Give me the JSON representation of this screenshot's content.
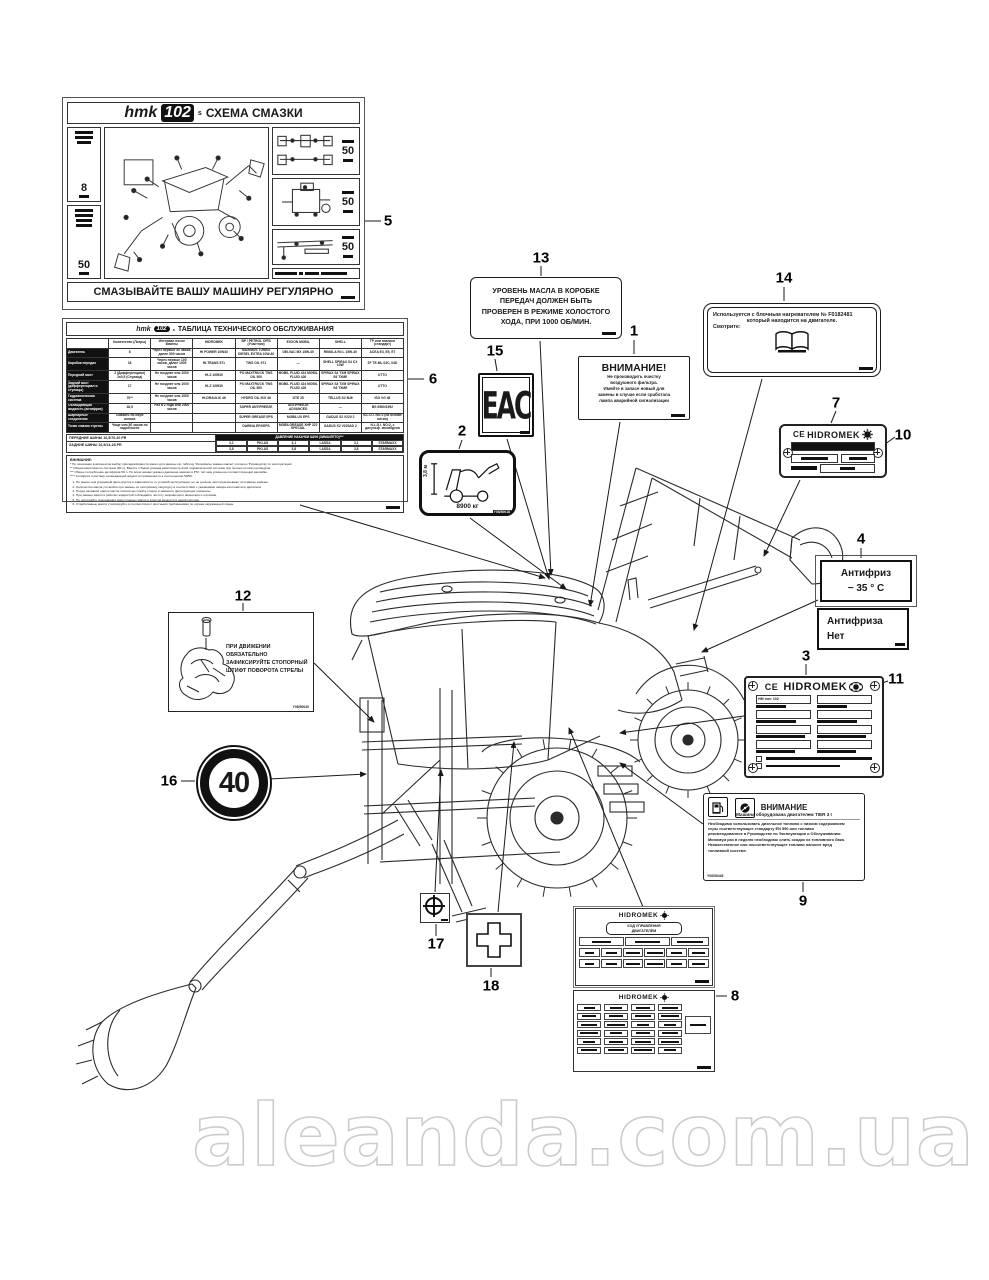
{
  "watermark": {
    "text": "aleanda.com.ua"
  },
  "callouts": {
    "c1": "1",
    "c2": "2",
    "c3": "3",
    "c4": "4",
    "c5": "5",
    "c6": "6",
    "c7": "7",
    "c8": "8",
    "c9": "9",
    "c10": "10",
    "c11": "11",
    "c12": "12",
    "c13": "13",
    "c14": "14",
    "c15": "15",
    "c16": "16",
    "c17": "17",
    "c18": "18"
  },
  "label5": {
    "brand": "hmk",
    "model": "102",
    "suffix": "s",
    "title": "СХЕМА СМАЗКИ",
    "footer": "СМАЗЫВАЙТЕ ВАШУ МАШИНУ РЕГУЛЯРНО",
    "interval_left": [
      "8",
      "50"
    ],
    "interval_right": [
      "50",
      "50",
      "50"
    ]
  },
  "label6": {
    "brand": "hmk",
    "model": "102",
    "suffix": "s",
    "title": "ТАБЛИЦА ТЕХНИЧЕСКОГО ОБСЛУЖИВАНИЯ",
    "columns": [
      "",
      "Количество (Литры)",
      "Интервал после замены",
      "HIDROMEK",
      "BP / PETROL OFİS (Участник)",
      "EXXON MOBIL",
      "SHELL",
      "ТР или аналоги (стандарт)"
    ],
    "rows": [
      [
        "Двигатель",
        "8",
        "Через первые 50 часов, далее 500 часов",
        "HI POWER 10W40",
        "MAXIMUS TURBO DIESEL EXTRA 10W-40",
        "DELVAC MX 15W-40",
        "RIMULA R4 L 15W-40",
        "ACEA E3, E5, E7"
      ],
      [
        "Коробка передач",
        "16",
        "Через первые 100 часов, далее 1000 часов",
        "HI-TRANS 971",
        "TWS OIL 971",
        "—",
        "SHELL SPIRAX S4 CX 10W",
        "ZF TE-ML 03C, 04D"
      ],
      [
        "Передний мост",
        "2 (Дифференциал) 2x0,5 (Ступица)",
        "Не позднее чем 1000 часов",
        "HI-Z 10W30",
        "PO MAXTRUCK TWS OIL 500",
        "MOBIL FLUID 424 MOBIL FLUID 426",
        "SPIRAX S4 TXM SPIRAX S6 TXME",
        "UTTO"
      ],
      [
        "Задний мост (дифференциал и ступицы)",
        "17",
        "Не позднее чем 1000 часов",
        "HI-Z 10W30",
        "PO MAXTRUCK TWS OIL 500",
        "MOBIL FLUID 424 MOBIL FLUID 426",
        "SPIRAX S4 TXM SPIRAX S6 TXME",
        "UTTO"
      ],
      [
        "Гидравлическая система",
        "70**",
        "Не позднее чем 1000 часов",
        "HI-DRAULIC 46",
        "HYDRO OIL ISO 46",
        "DTE 25",
        "TELLUS S2 B46",
        "ISO VG 46"
      ],
      [
        "Охлаждающая жидкость (антифриз)",
        "18,5",
        "Раз в 2 года или 2000 часов",
        "",
        "SUPER ANTIFREEZE",
        "ANTIFREEZE ADVANCED",
        "—",
        "BS 6580/1992"
      ],
      [
        "Шарнирные соединения",
        "Смазать по мере износа",
        "",
        "",
        "SUPER GREASE EPS",
        "MOBILUX EPS",
        "GADUS S2 V220 2",
        "N.L.G.I. NO:2 (на основе лития)"
      ],
      [
        "Точки смазки стрелы",
        "Чаще чем 50 часов по надобности",
        "",
        "",
        "DARINA EP2/EPS",
        "MOBILGREASE XHP 222 SPECIAL",
        "GADUS S2 V220AD 2",
        "N.L.G.I. NO:2, с дисульф. молибдена"
      ]
    ],
    "tires_front": "ПЕРЕДНИЕ ШИНЫ   16,5/70-20 PR",
    "tires_rear": "ЗАДНИЕ ШИНЫ   16,9/14-28 PR",
    "pressure_title": "ДАВЛЕНИЕ НАКАЧКИ ШИН (ЗИМА/ЛЕТО)***",
    "pressure_rows": [
      [
        "3,1",
        "PKLAS",
        "4,1",
        "LASSA",
        "3,1",
        "STARMAXX"
      ],
      [
        "3,8",
        "PKLAS",
        "3,8",
        "LASSA",
        "3,8",
        "STARMAXX"
      ]
    ],
    "notes_title": "ВНИМАНИЕ:",
    "notes": [
      "* По окончании компонентов выбор присадок/вязкости масел для замены см. таблицу 'Интервалы замены масел' согласно 'Руководству по эксплуатации'.",
      "** Общая вместимость системы (80 л). Вместе с баком указана вместимость всей гидравлической системы при полных штоках цилиндров.",
      "*** Общее потребление антифриза 50 л. По всем шинам указано давление накачки в PSI; тип шин указан на соответствующей наклейке.",
      "**** Антифриз и раствор охлаждающей жидкости применяются в соотношении 50/50."
    ],
    "list": [
      "Не менее чем указанный фильтруется в зависимости от условий эксплуатации, но не дольше чем предписывают интервалы замены.",
      "Количество масла уточняйте при замене по смотровому окну/щупу в соответствии с указаниями завода-изготовителя двигателя.",
      "Перед заливкой нового масла полностью слейте старое и замените фильтрующие элементы.",
      "При замене масел и рабочих жидкостей соблюдайте чистоту заправочного инвентаря и горловин.",
      "Не допускайте смешивания масел разных марок и классов вязкости в одной системе.",
      "Отработанные масла утилизируйте в соответствии с местными требованиями по охране окружающей среды."
    ]
  },
  "label13": {
    "lines": [
      "УРОВЕНЬ МАСЛА В КОРОБКЕ",
      "ПЕРЕДАЧ ДОЛЖЕН БЫТЬ",
      "ПРОВЕРЕН В РЕЖИМЕ ХОЛОСТОГО",
      "ХОДА, ПРИ 1000 ОБ/МИН."
    ]
  },
  "label14": {
    "line1": "Используется с блочным нагревателем  №  F0182481",
    "line2": "который находится на двигателе.",
    "line3": "Смотрите:"
  },
  "label1": {
    "title": "ВНИМАНИЕ!",
    "lines": [
      "Не производить очистку",
      "воздушного фильтра.",
      "Имейте в запасе новый для",
      "замены в случае если сработала",
      "лампа аварийной сигнализации"
    ]
  },
  "label15": {
    "text": "EAC"
  },
  "label2": {
    "height": "3,8 м",
    "weight": "8900 кг",
    "code": "Y08/50018"
  },
  "label7": {
    "ce": "CE",
    "brand": "HIDROMEK"
  },
  "label10_note": "",
  "label4": {
    "top1": "Антифриз",
    "top2": "− 35 ° C",
    "bottom1": "Антифриза",
    "bottom2": "Нет"
  },
  "label3": {
    "ce": "CE",
    "brand": "HIDROMEK",
    "field1": "HM тип: 102"
  },
  "label9": {
    "title": "ВНИМАНИЕ",
    "subtitle": "Машина оборудована двигателем TIER 3 I",
    "lines": [
      "Необходимо использовать дизельное топливо с низким содержанием",
      "серы соответствующее стандарту EN 590 или топливо",
      "рекомендованное в Руководстве по Эксплуатации и Обслуживанию.",
      "Минимум раз в неделю необходимо слить осадок из топливного бака.",
      "Некачественное или несоответствующее топливо наносит вред",
      "топливной системе."
    ],
    "code": "Y08/50445"
  },
  "label12": {
    "lines": [
      "ПРИ ДВИЖЕНИИ ОБЯЗАТЕЛЬНО",
      "ЗАФИКСИРУЙТЕ СТОПОРНЫЙ",
      "ШТИФТ ПОВОРОТА СТРЕЛЫ"
    ],
    "code": "Y08/50040"
  },
  "label16": {
    "value": "40"
  },
  "label8": {
    "brand": "HIDROMEK",
    "box_line1": "КОД УПРАВЛЕНИЯ",
    "box_line2": "ДВИГАТЕЛЕМ"
  }
}
